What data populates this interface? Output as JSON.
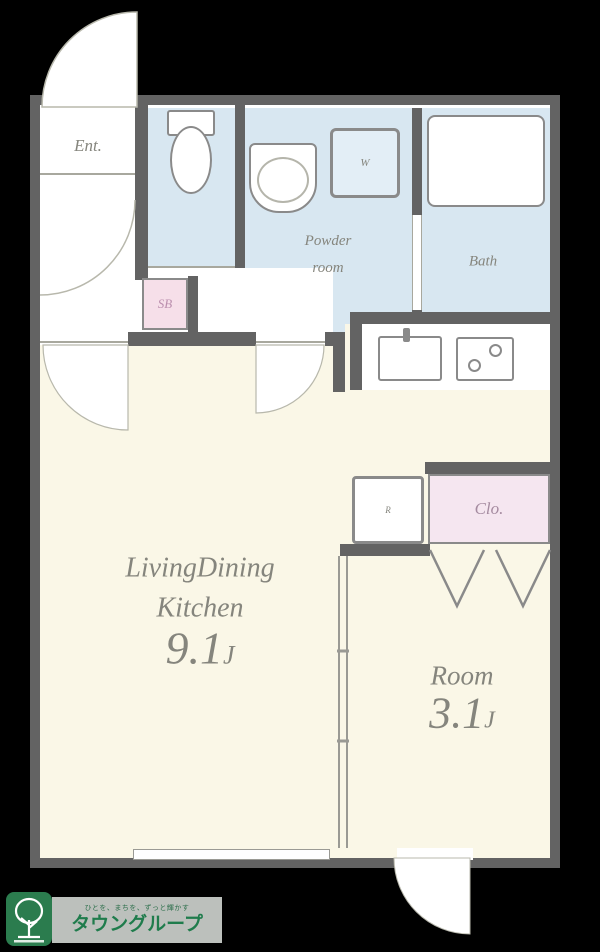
{
  "plan": {
    "entrance_label": "Ent.",
    "washer_label": "W",
    "shoebox_label": "SB",
    "powder_label_1": "Powder",
    "powder_label_2": "room",
    "bath_label": "Bath",
    "fridge_label": "R",
    "closet_label": "Clo.",
    "ldk_label_1": "LivingDining",
    "ldk_label_2": "Kitchen",
    "ldk_size": "9.1",
    "ldk_size_unit": "J",
    "room_label": "Room",
    "room_size": "3.1",
    "room_size_unit": "J"
  },
  "logo": {
    "tagline": "ひとを、まちを、ずっと輝かす",
    "brand": "タウングループ"
  },
  "colors": {
    "background": "#000000",
    "wall": "#636363",
    "floor_cream": "#faf7e7",
    "floor_wet_blue": "#d8e7f1",
    "closet_pink": "#f5e6f0",
    "shoebox_pink": "#f6dfe9",
    "label_gray": "#85857d",
    "logo_green": "#2b7c4e"
  }
}
